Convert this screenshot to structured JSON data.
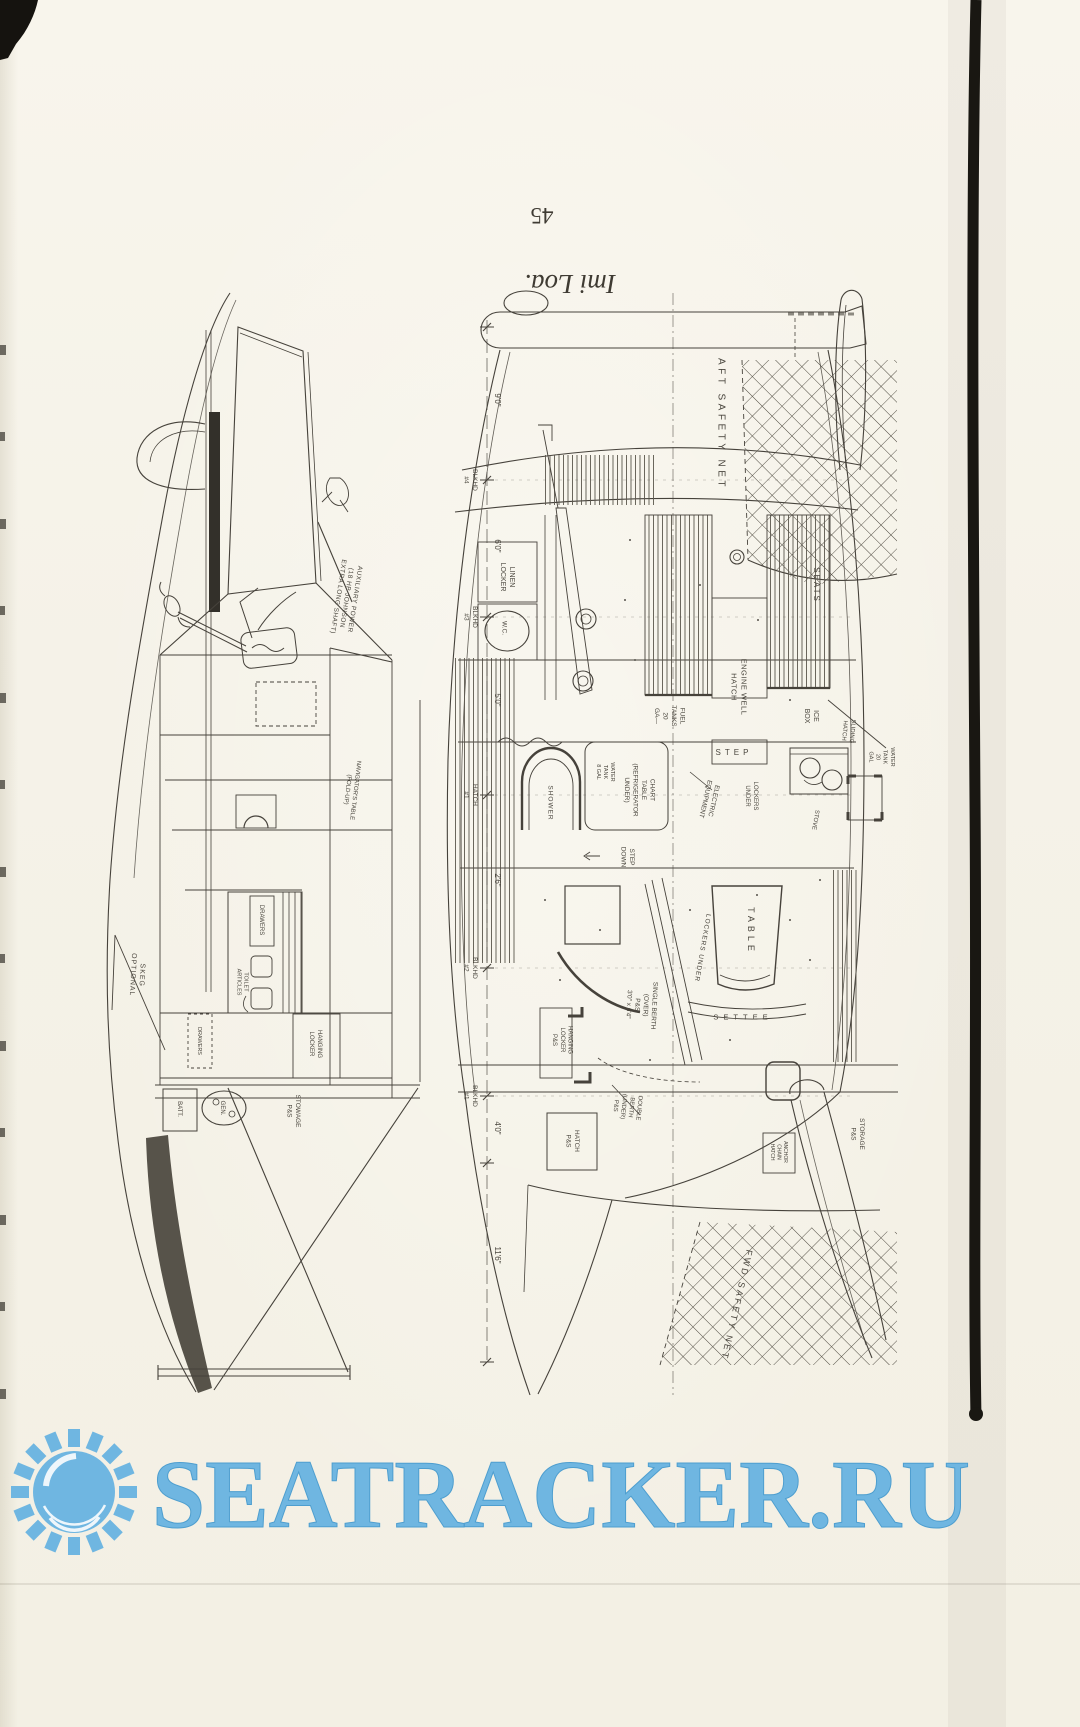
{
  "page": {
    "number": "45",
    "caption": "Imi Loa."
  },
  "watermark": {
    "text": "SEATRACKER.RU",
    "color": "#6fb6e1",
    "icon": "sun-icon"
  },
  "profile_view": {
    "labels": [
      {
        "lines": [
          "AUXILIARY POWER",
          "(18 HP JOHNSON",
          "EXTRA LONG SHAFT)"
        ],
        "x": 347,
        "y": 598,
        "rot": 99,
        "fs": 6.5,
        "ls": 0.5
      },
      {
        "lines": [
          "NAVIGATOR'S TABLE",
          "(FOLD-UP)"
        ],
        "x": 352,
        "y": 790,
        "rot": 97,
        "fs": 6,
        "ls": 0
      },
      {
        "lines": [
          "SKEG",
          "OPTIONAL"
        ],
        "x": 138,
        "y": 975,
        "rot": 93,
        "fs": 7,
        "ls": 1
      },
      {
        "lines": [
          "DRAWERS"
        ],
        "x": 262,
        "y": 920,
        "rot": 90,
        "fs": 6,
        "ls": 0
      },
      {
        "lines": [
          "TOILET",
          "ARTICLES"
        ],
        "x": 243,
        "y": 982,
        "rot": 90,
        "fs": 5.5,
        "ls": 0
      },
      {
        "lines": [
          "DRAWERS"
        ],
        "x": 200,
        "y": 1041,
        "rot": 90,
        "fs": 5.5,
        "ls": 0
      },
      {
        "lines": [
          "HANGING",
          "LOCKER"
        ],
        "x": 316,
        "y": 1044,
        "rot": 90,
        "fs": 6,
        "ls": 0
      },
      {
        "lines": [
          "BATT."
        ],
        "x": 180,
        "y": 1109,
        "rot": 90,
        "fs": 6,
        "ls": 0
      },
      {
        "lines": [
          "GEN."
        ],
        "x": 223,
        "y": 1108,
        "rot": 90,
        "fs": 6,
        "ls": 0
      },
      {
        "lines": [
          "STOWAGE",
          "P&S"
        ],
        "x": 294,
        "y": 1111,
        "rot": 90,
        "fs": 6.5,
        "ls": 0
      }
    ]
  },
  "plan_view": {
    "labels": [
      {
        "lines": [
          "AFT SAFETY NET"
        ],
        "x": 722,
        "y": 424,
        "rot": 90,
        "fs": 10,
        "ls": 3.5
      },
      {
        "lines": [
          "LINEN",
          "LOCKER"
        ],
        "x": 508,
        "y": 577,
        "rot": 90,
        "fs": 7,
        "ls": 0
      },
      {
        "lines": [
          "W.C."
        ],
        "x": 505,
        "y": 628,
        "rot": 90,
        "fs": 6.5,
        "ls": 0
      },
      {
        "lines": [
          "SEATS"
        ],
        "x": 817,
        "y": 585,
        "rot": 90,
        "fs": 8,
        "ls": 2
      },
      {
        "lines": [
          "ENGINE WELL",
          "HATCH"
        ],
        "x": 739,
        "y": 687,
        "rot": 90,
        "fs": 7.5,
        "ls": 0.5
      },
      {
        "lines": [
          "FUEL",
          "TANKS",
          "20",
          "GA—"
        ],
        "x": 670,
        "y": 716,
        "rot": 90,
        "fs": 6.5,
        "ls": 0
      },
      {
        "lines": [
          "ICE",
          "BOX"
        ],
        "x": 812,
        "y": 716,
        "rot": 90,
        "fs": 7,
        "ls": 0
      },
      {
        "lines": [
          "STEP"
        ],
        "x": 734,
        "y": 752,
        "rot": 0,
        "fs": 8,
        "ls": 4
      },
      {
        "lines": [
          "SHOWER"
        ],
        "x": 551,
        "y": 803,
        "rot": 90,
        "fs": 6.5,
        "ls": 1
      },
      {
        "lines": [
          "WATER",
          "TANK",
          "8 GAL"
        ],
        "x": 606,
        "y": 772,
        "rot": 90,
        "fs": 5.5,
        "ls": 0
      },
      {
        "lines": [
          "CHART",
          "TABLE",
          "(REFRIGERATOR",
          "UNDER)"
        ],
        "x": 640,
        "y": 790,
        "rot": 90,
        "fs": 6.5,
        "ls": 0
      },
      {
        "lines": [
          "ELECTRIC",
          "EQUIPMENT"
        ],
        "x": 710,
        "y": 800,
        "rot": 103,
        "fs": 6.5,
        "ls": 0
      },
      {
        "lines": [
          "LOCKERS",
          "UNDER"
        ],
        "x": 752,
        "y": 796,
        "rot": 90,
        "fs": 6,
        "ls": 0
      },
      {
        "lines": [
          "WATER",
          "TANK",
          "20",
          "GAL"
        ],
        "x": 882,
        "y": 757,
        "rot": 90,
        "fs": 5.5,
        "ls": 0
      },
      {
        "lines": [
          "SLIDING",
          "HATCH"
        ],
        "x": 849,
        "y": 731,
        "rot": 95,
        "fs": 6,
        "ls": 0
      },
      {
        "lines": [
          "STOVE"
        ],
        "x": 816,
        "y": 820,
        "rot": 100,
        "fs": 6,
        "ls": 0
      },
      {
        "lines": [
          "STEP",
          "DOWN"
        ],
        "x": 628,
        "y": 857,
        "rot": 90,
        "fs": 6.5,
        "ls": 0
      },
      {
        "lines": [
          "TABLE"
        ],
        "x": 751,
        "y": 931,
        "rot": 90,
        "fs": 9,
        "ls": 4
      },
      {
        "lines": [
          "LOCKERS UNDER"
        ],
        "x": 703,
        "y": 948,
        "rot": 100,
        "fs": 6.5,
        "ls": 1
      },
      {
        "lines": [
          "SETTEE"
        ],
        "x": 743,
        "y": 1017,
        "rot": 0,
        "fs": 7.5,
        "ls": 5
      },
      {
        "lines": [
          "SINGLE BERTH",
          "(OVER)",
          "P&S",
          "3'0\" x 6'4\""
        ],
        "x": 642,
        "y": 1005,
        "rot": 93,
        "fs": 6.5,
        "ls": 0
      },
      {
        "lines": [
          "HANGING",
          "LOCKER",
          "P&S"
        ],
        "x": 563,
        "y": 1040,
        "rot": 90,
        "fs": 6,
        "ls": 0
      },
      {
        "lines": [
          "DOUBLE",
          "BERTH",
          "(UNDER)",
          "P&S"
        ],
        "x": 628,
        "y": 1107,
        "rot": 96,
        "fs": 6,
        "ls": 0
      },
      {
        "lines": [
          "HATCH",
          "P&S"
        ],
        "x": 573,
        "y": 1141,
        "rot": 90,
        "fs": 6.5,
        "ls": 0
      },
      {
        "lines": [
          "ANCHOR",
          "CHAIN",
          "HATCH"
        ],
        "x": 779,
        "y": 1152,
        "rot": 90,
        "fs": 5,
        "ls": 0
      },
      {
        "lines": [
          "STORAGE",
          "P&S"
        ],
        "x": 858,
        "y": 1134,
        "rot": 90,
        "fs": 6.5,
        "ls": 0
      },
      {
        "lines": [
          "FWD SAFETY NET"
        ],
        "x": 737,
        "y": 1305,
        "rot": 103,
        "fs": 9,
        "ls": 2.5
      }
    ],
    "dimension_chain": {
      "axis_x": 487,
      "ticks": [
        327,
        480,
        617,
        795,
        968,
        1096,
        1163,
        1362
      ],
      "dims": [
        {
          "value": "9'0\"",
          "y": 400
        },
        {
          "value": "6'0\"",
          "y": 546
        },
        {
          "value": "5'0\"",
          "y": 700
        },
        {
          "value": "2'6\"",
          "y": 880
        },
        {
          "value": "4'0\"",
          "y": 1128
        },
        {
          "value": "11'6\"",
          "y": 1255
        }
      ],
      "stations": [
        {
          "lines": [
            "BLKHD",
            "#4"
          ],
          "y": 480
        },
        {
          "lines": [
            "BLKHD",
            "#3"
          ],
          "y": 617
        },
        {
          "lines": [
            "HATCH",
            "#1"
          ],
          "y": 795
        },
        {
          "lines": [
            "BLKHD",
            "#2"
          ],
          "y": 968
        },
        {
          "lines": [
            "BLKHD",
            "#1"
          ],
          "y": 1096
        }
      ]
    }
  }
}
